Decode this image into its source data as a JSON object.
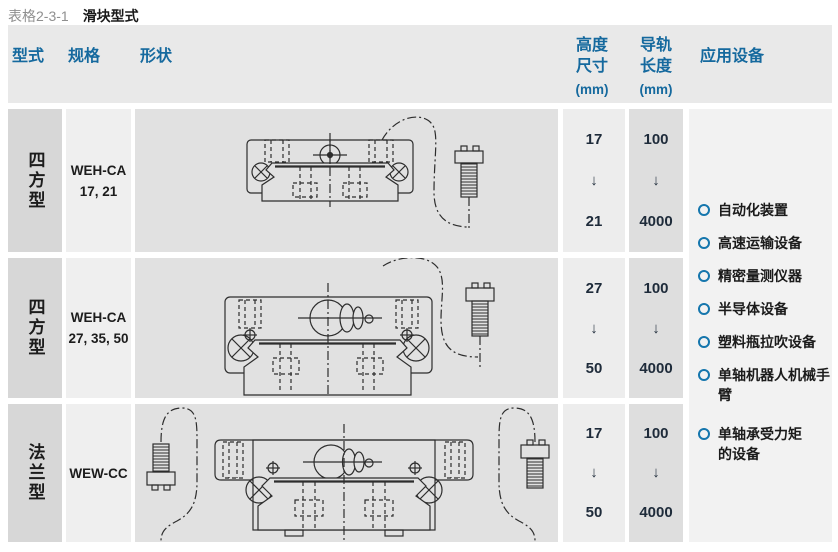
{
  "caption": {
    "number": "表格2-3-1",
    "title": "滑块型式"
  },
  "columns": {
    "type": "型式",
    "spec": "规格",
    "shape": "形状",
    "height": "高度\n尺寸",
    "height_unit": "(mm)",
    "rail_length": "导轨\n长度",
    "rail_unit": "(mm)",
    "applications": "应用设备"
  },
  "rows": [
    {
      "type": "四方型",
      "spec": "WEH-CA\n17, 21",
      "height_min": "17",
      "height_max": "21",
      "rail_min": "100",
      "rail_max": "4000"
    },
    {
      "type": "四方型",
      "spec": "WEH-CA\n27, 35, 50",
      "height_min": "27",
      "height_max": "50",
      "rail_min": "100",
      "rail_max": "4000"
    },
    {
      "type": "法兰型",
      "spec": "WEW-CC",
      "height_min": "17",
      "height_max": "50",
      "rail_min": "100",
      "rail_max": "4000"
    }
  ],
  "symbols": {
    "down_arrow": "↓"
  },
  "applications": [
    "自动化装置",
    "高速运输设备",
    "精密量测仪器",
    "半导体设备",
    "塑料瓶拉吹设备",
    "单轴机器人机械手\n臂",
    "单轴承受力矩\n的设备"
  ],
  "colors": {
    "accent_blue": "#15699e",
    "bullet_blue": "#1576ad",
    "number_text": "#1e2b3a",
    "header_bg": "#e9e9e9",
    "col_type_bg": "#d7d7d7",
    "col_spec_bg": "#efefef",
    "col_shape_bg": "#e1e1e1",
    "col_height_bg": "#ededed",
    "col_rail_bg": "#dedede",
    "col_apps_bg": "#f2f2f2"
  }
}
